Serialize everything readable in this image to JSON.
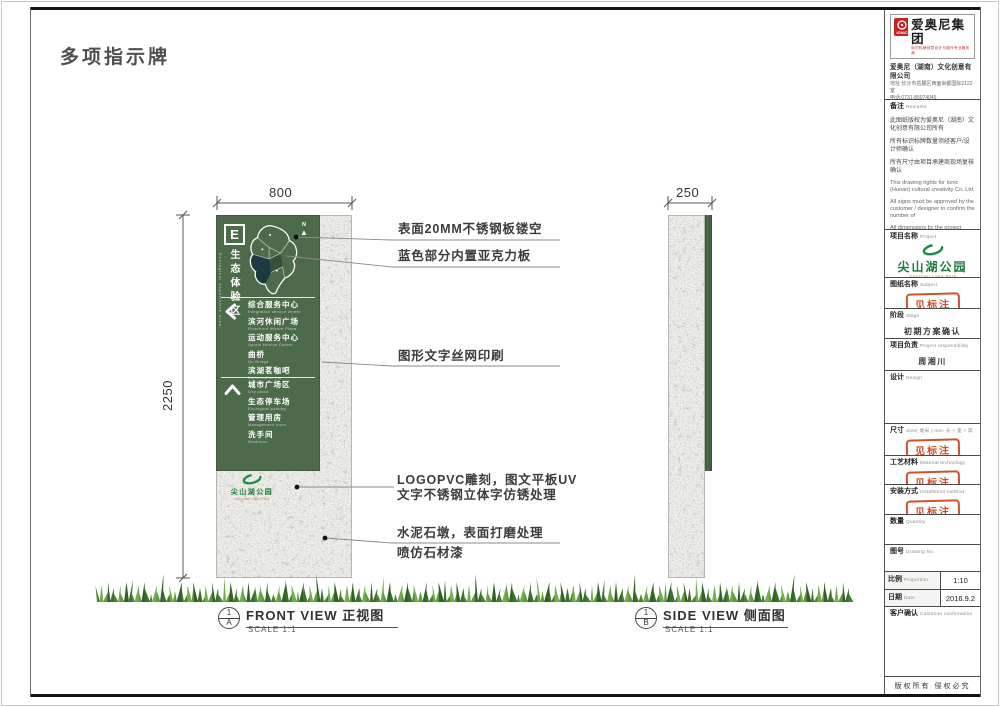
{
  "page": {
    "title": "多项指示牌",
    "copyright": "版权所有  侵权必究"
  },
  "dims": {
    "front_width": "800",
    "front_height": "2250",
    "side_width": "250"
  },
  "views": {
    "front": {
      "title": "FRONT VIEW 正视图",
      "scale": "SCALE 1:1",
      "ref_num": "1",
      "ref_letter": "A"
    },
    "side": {
      "title": "SIDE VIEW  侧面图",
      "scale": "SCALE 1:1",
      "ref_num": "1",
      "ref_letter": "B"
    }
  },
  "annotations": {
    "steel": "表面20MM不锈钢板镂空",
    "acrylic": "蓝色部分内置亚克力板",
    "silkscreen": "图形文字丝网印刷",
    "logo_line1": "LOGOPVC雕刻，图文平板UV",
    "logo_line2": "文字不锈钢立体字仿锈处理",
    "base_line1": "水泥石墩，表面打磨处理",
    "base_line2": "喷仿石材漆"
  },
  "sign": {
    "zone_code": "E",
    "zone_name": "生态体验区",
    "zone_name_en": "Ecological experience area",
    "north_label": "N",
    "left_items": [
      {
        "zh": "综合服务中心",
        "en": "Integration service center"
      },
      {
        "zh": "滨河休闲广场",
        "en": "Riverfront leisure Plaza"
      },
      {
        "zh": "运动服务中心",
        "en": "Sports service Center"
      },
      {
        "zh": "曲桥",
        "en": "Qu Bridge"
      },
      {
        "zh": "滨湖茗咖吧",
        "en": "Binhu coffee bar"
      }
    ],
    "up_items": [
      {
        "zh": "城市广场区",
        "en": "City plaza"
      },
      {
        "zh": "生态停车场",
        "en": "Ecological parking"
      },
      {
        "zh": "管理用房",
        "en": "Management room"
      },
      {
        "zh": "洗手间",
        "en": "Restroom"
      }
    ],
    "park_name": "尖山湖公园",
    "park_name_en": "Jianshan Lake Park"
  },
  "titleblock": {
    "company": {
      "group_name": "爱奥尼集团",
      "logo_text": "IONIC",
      "tagline": "标识标牌创意设计与制作专业服务商",
      "full_name": "爱奥尼（湖南）文化创意有限公司",
      "address": "地址:长沙市岳麓区西面尚都国际2122室",
      "phone": "电话:0731-85074045",
      "website": "http://www.ionic.net.cn"
    },
    "remarks": {
      "label_zh": "备注",
      "label_en": "Remarks",
      "zh1": "此图纸版权为爱奥尼（湖南）文化创意有限公司所有",
      "zh2": "所有标识标牌数量须经客户/设计师确认",
      "zh3": "所有尺寸由项目承建商现场复核确认",
      "en1": "This drawing rights for Ionic (Hunan) cultural creativity Co. Ltd.",
      "en2": "All signs must be approved by the customer / designer to confirm the number of",
      "en3": "All dimensions by the project contractors on site review confirmed"
    },
    "project": {
      "label_zh": "项目名称",
      "label_en": "Project"
    },
    "subject": {
      "label_zh": "图纸名称",
      "label_en": "Subject",
      "stamp": "见标注"
    },
    "stage": {
      "label_zh": "阶段",
      "label_en": "Stage",
      "value": "初期方案确认"
    },
    "responsibility": {
      "label_zh": "项目负责",
      "label_en": "Project responsibility",
      "value": "周湘川"
    },
    "design": {
      "label_zh": "设计",
      "label_en": "Design",
      "value": ""
    },
    "size": {
      "label_zh": "尺寸",
      "label_en": "Size( 毫米 ) mm: 长 × 宽 × 高",
      "stamp": "见标注"
    },
    "material": {
      "label_zh": "工艺材料",
      "label_en": "Material technology",
      "stamp": "见标注"
    },
    "install": {
      "label_zh": "安装方式",
      "label_en": "Installation method",
      "stamp": "见标注"
    },
    "quantity": {
      "label_zh": "数量",
      "label_en": "Quantity",
      "value": ""
    },
    "drawing_no": {
      "label_zh": "图号",
      "label_en": "Drawing No",
      "value": ""
    },
    "proportion": {
      "label_zh": "比例",
      "label_en": "Proportion",
      "value": "1:10"
    },
    "date": {
      "label_zh": "日期",
      "label_en": "Date",
      "value": "2016.9.2"
    },
    "customer": {
      "label_zh": "客户确认",
      "label_en": "Customer confirmation",
      "value": ""
    }
  }
}
